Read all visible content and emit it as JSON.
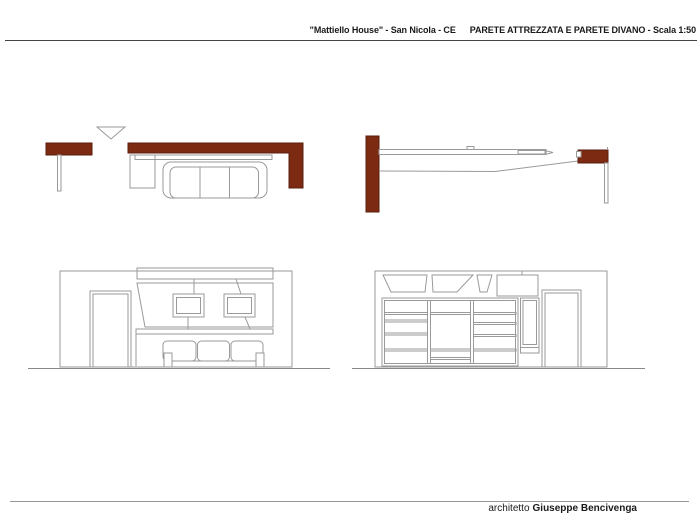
{
  "header": {
    "title_project": "\"Mattiello House\" - San Nicola - CE",
    "title_drawing": "PARETE ATTREZZATA E PARETE DIVANO - Scala 1:50"
  },
  "footer": {
    "role": "architetto",
    "name": "Giuseppe Bencivenga"
  },
  "colors": {
    "background": "#ffffff",
    "text": "#1a1a1a",
    "rule_dark": "#444444",
    "rule_light": "#999999",
    "line": "#9a9a9a",
    "line_dark": "#888888",
    "wall_fill": "#7d2a13",
    "wall_stroke": "#591e0c"
  }
}
